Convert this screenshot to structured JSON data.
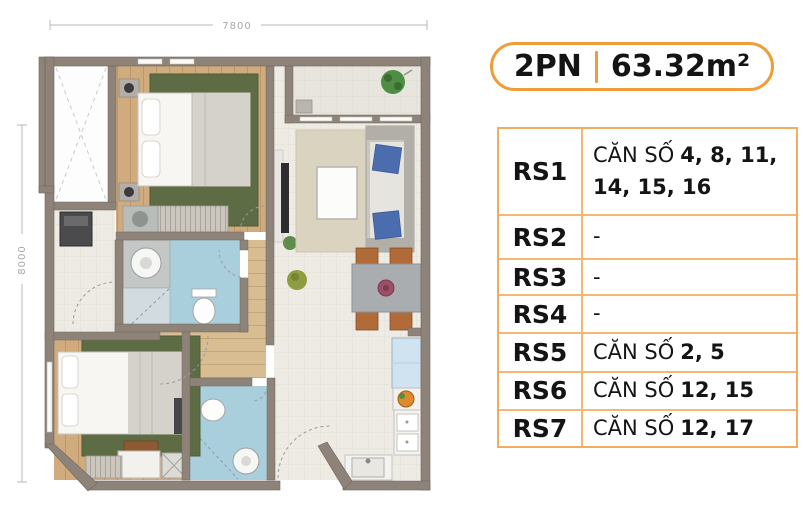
{
  "floor_plan": {
    "width_label": "7800",
    "height_label": "8000"
  },
  "unit_badge": {
    "bedrooms": "2PN",
    "area": "63.32m²"
  },
  "availability_table": {
    "rows": [
      {
        "label": "RS1",
        "prefix": "CĂN SỐ",
        "numbers": "4, 8, 11, 14, 15, 16"
      },
      {
        "label": "RS2",
        "prefix": "-",
        "numbers": ""
      },
      {
        "label": "RS3",
        "prefix": "-",
        "numbers": ""
      },
      {
        "label": "RS4",
        "prefix": "-",
        "numbers": ""
      },
      {
        "label": "RS5",
        "prefix": "CĂN SỐ",
        "numbers": "2, 5"
      },
      {
        "label": "RS6",
        "prefix": "CĂN SỐ",
        "numbers": "12, 15"
      },
      {
        "label": "RS7",
        "prefix": "CĂN SỐ",
        "numbers": "12, 17"
      }
    ]
  },
  "colors": {
    "accent_orange": "#ee9d3a",
    "table_border": "#f2ac60",
    "wall": "#8d8378",
    "bathroom_blue": "#aacfdc",
    "wood_floor": "#cfab7d",
    "rug_green": "#5e6c45"
  }
}
